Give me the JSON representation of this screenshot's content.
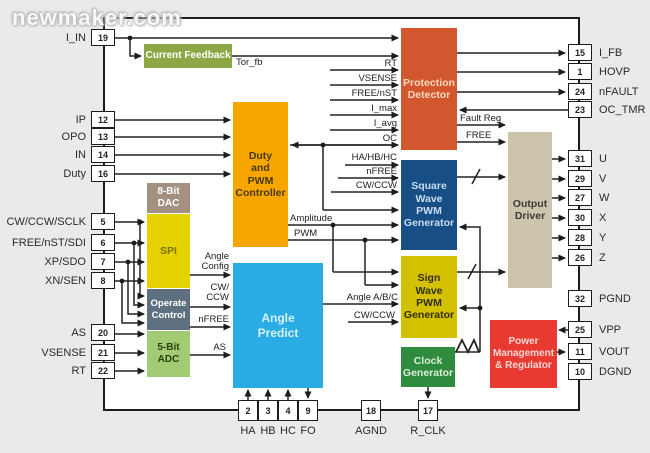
{
  "watermark": "newmaker.com",
  "blocks": {
    "current_feedback": "Current Feedback",
    "duty_pwm": "Duty\nand\nPWM\nController",
    "protection": "Protection\nDetector",
    "square_gen": "Square\nWave\nPWM\nGenerator",
    "sign_gen": "Sign\nWave\nPWM\nGenerator",
    "clock_gen": "Clock\nGenerator",
    "output_driver": "Output\nDriver",
    "power_mgmt": "Power\nManagement\n& Regulator",
    "angle_predict": "Angle\nPredict",
    "dac": "8-Bit\nDAC",
    "spi": "SPI",
    "operate": "Operate\nControl",
    "adc": "5-Bit\nADC"
  },
  "signals": {
    "tor_fb": "Tor_fb",
    "rt": "RT",
    "vsense": "VSENSE",
    "free_nst": "FREE/nST",
    "i_max": "I_max",
    "i_avg": "I_avg",
    "oc": "OC",
    "fault_reg": "Fault Reg",
    "free": "FREE",
    "ha_hb_hc": "HA/HB/HC",
    "nfree_sq": "nFREE",
    "cw_ccw_sq": "CW/CCW",
    "amplitude": "Amplitude",
    "pwm": "PWM",
    "angle_abc": "Angle A/B/C",
    "cw_ccw_sign": "CW/CCW",
    "angle_config": "Angle\nConfig",
    "cw_ccw_ap": "CW/\nCCW",
    "nfree_ap": "nFREE",
    "as_ap": "AS"
  },
  "pins": {
    "left": [
      {
        "num": "19",
        "name": "I_IN"
      },
      {
        "num": "12",
        "name": "IP"
      },
      {
        "num": "13",
        "name": "OPO"
      },
      {
        "num": "14",
        "name": "IN"
      },
      {
        "num": "16",
        "name": "Duty"
      },
      {
        "num": "5",
        "name": "CW/CCW/SCLK"
      },
      {
        "num": "6",
        "name": "FREE/nST/SDI"
      },
      {
        "num": "7",
        "name": "XP/SDO"
      },
      {
        "num": "8",
        "name": "XN/SEN"
      },
      {
        "num": "20",
        "name": "AS"
      },
      {
        "num": "21",
        "name": "VSENSE"
      },
      {
        "num": "22",
        "name": "RT"
      }
    ],
    "right": [
      {
        "num": "15",
        "name": "I_FB"
      },
      {
        "num": "1",
        "name": "HOVP"
      },
      {
        "num": "24",
        "name": "nFAULT"
      },
      {
        "num": "23",
        "name": "OC_TMR"
      },
      {
        "num": "31",
        "name": "U"
      },
      {
        "num": "29",
        "name": "V"
      },
      {
        "num": "27",
        "name": "W"
      },
      {
        "num": "30",
        "name": "X"
      },
      {
        "num": "28",
        "name": "Y"
      },
      {
        "num": "26",
        "name": "Z"
      },
      {
        "num": "32",
        "name": "PGND"
      },
      {
        "num": "25",
        "name": "VPP"
      },
      {
        "num": "11",
        "name": "VOUT"
      },
      {
        "num": "10",
        "name": "DGND"
      }
    ],
    "bottom": [
      {
        "num": "2",
        "name": "HA"
      },
      {
        "num": "3",
        "name": "HB"
      },
      {
        "num": "4",
        "name": "HC"
      },
      {
        "num": "9",
        "name": "FO"
      },
      {
        "num": "18",
        "name": "AGND"
      },
      {
        "num": "17",
        "name": "R_CLK"
      }
    ]
  },
  "colors": {
    "background": "#e9ebe8",
    "chip_fill": "#ffffff",
    "line": "#222222",
    "current_feedback": "#8CA845",
    "duty_pwm": "#F7A600",
    "protection": "#D2572E",
    "square_gen": "#174E86",
    "sign_gen": "#D3C100",
    "clock_gen": "#2F8C3F",
    "output_driver": "#CCC4AD",
    "power_mgmt": "#E83A30",
    "angle_predict": "#29ACE3",
    "dac": "#A29080",
    "spi": "#E5D200",
    "operate": "#5E7080",
    "adc": "#A3CB73"
  }
}
